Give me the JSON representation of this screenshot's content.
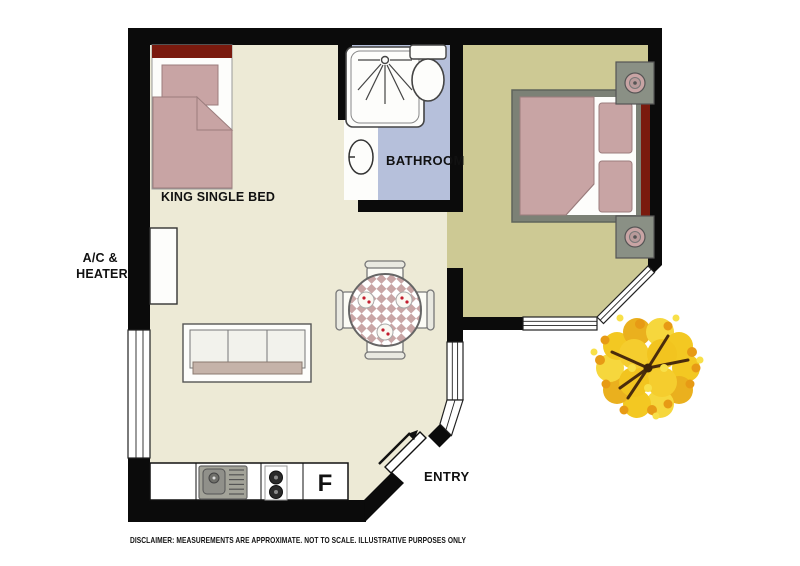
{
  "floorplan": {
    "labels": {
      "king_single_bed": "KING SINGLE BED",
      "ac_heater": [
        "A/C &",
        "HEATER"
      ],
      "bathroom": "BATHROOM",
      "entry": "ENTRY",
      "fridge": "F",
      "disclaimer": "DISCLAIMER: MEASUREMENTS ARE APPROXIMATE.  NOT TO SCALE.  ILLUSTRATIVE PURPOSES ONLY"
    },
    "furniture_icons": [
      "king-single-bed-icon",
      "double-bed-icon",
      "nightstand-lamp-icon",
      "shower-icon",
      "toilet-icon",
      "sink-icon",
      "sofa-icon",
      "dining-table-chairs-icon",
      "kitchen-sink-icon",
      "stove-icon",
      "fridge-icon",
      "entry-door-arrow-icon",
      "tree-icon",
      "ac-heater-unit-icon"
    ],
    "colors": {
      "wall": "#0b0b0b",
      "main_floor": "#EDEAD6",
      "bathroom_floor": "#B6C0DB",
      "bedroom_floor": "#CDC994",
      "bed_pink": "#C8A4A4",
      "headboard_red": "#7A1A0E",
      "bed_frame_gray": "#7C8176",
      "counter_gray": "#A3A399",
      "tree_yellow": "#F3C822",
      "tree_orange": "#E79A15",
      "branch_brown": "#4A2C0C"
    }
  }
}
